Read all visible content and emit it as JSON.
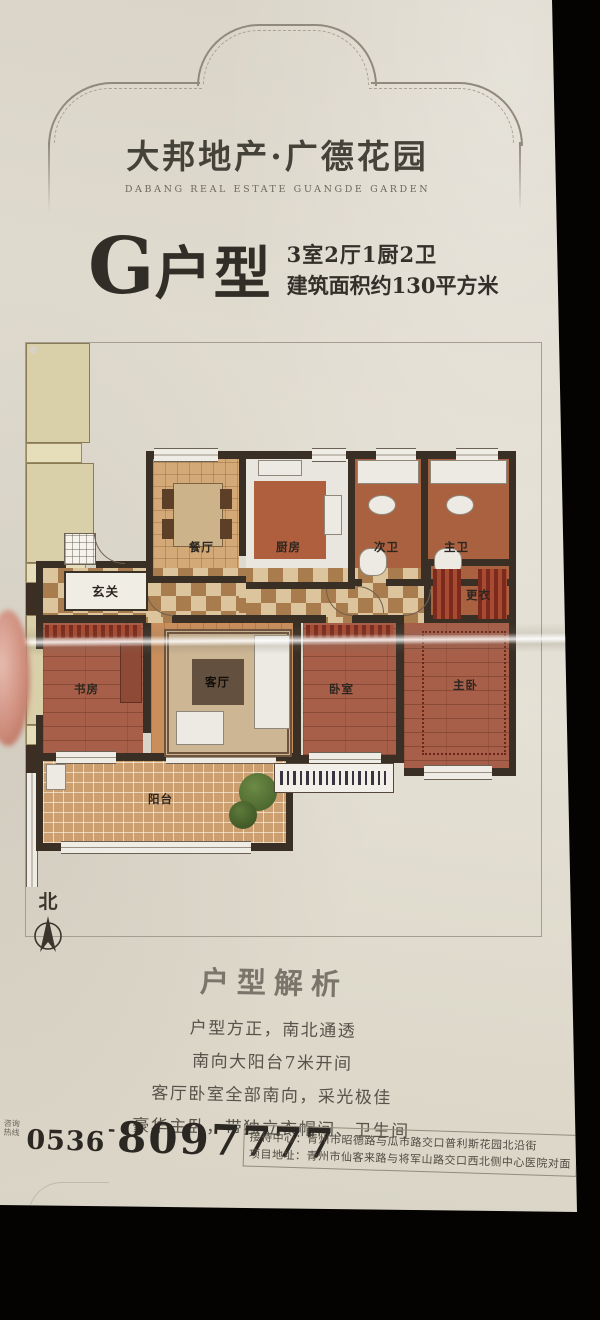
{
  "header": {
    "title": "大邦地产·广德花园",
    "subtitle": "DABANG REAL ESTATE GUANGDE GARDEN"
  },
  "unit": {
    "type_letter": "G",
    "type_suffix": "户型",
    "spec": "3室2厅1厨2卫",
    "area": "建筑面积约130平方米"
  },
  "floorplan": {
    "north_label": "北",
    "rooms": {
      "entry": "玄关",
      "dining": "餐厅",
      "kitchen": "厨房",
      "second_bath": "次卫",
      "master_bath": "主卫",
      "closet": "更衣",
      "study": "书房",
      "living": "客厅",
      "bedroom": "卧室",
      "master_bedroom": "主卧",
      "balcony": "阳台"
    }
  },
  "analysis": {
    "heading": "户型解析",
    "points": [
      "户型方正，南北通透",
      "南向大阳台7米开间",
      "客厅卧室全部南向，采光极佳",
      "豪华主卧，带独立衣帽间、卫生间"
    ]
  },
  "footer": {
    "hotline_label_top": "咨询",
    "hotline_label_bottom": "热线",
    "phone_area_code": "0536",
    "phone_separator": "-",
    "phone_number": "8097777",
    "reception": "接待中心：青州市昭德路与瓜市路交口普利斯花园北沿街",
    "address": "项目地址：青州市仙客来路与将军山路交口西北侧中心医院对面"
  },
  "colors": {
    "paper": "#e0dbcf",
    "wall": "#3a2f25",
    "wood_floor": "#a75f49",
    "hatch_red": "#7b2a1c",
    "tile_tan": "#d2a977"
  }
}
